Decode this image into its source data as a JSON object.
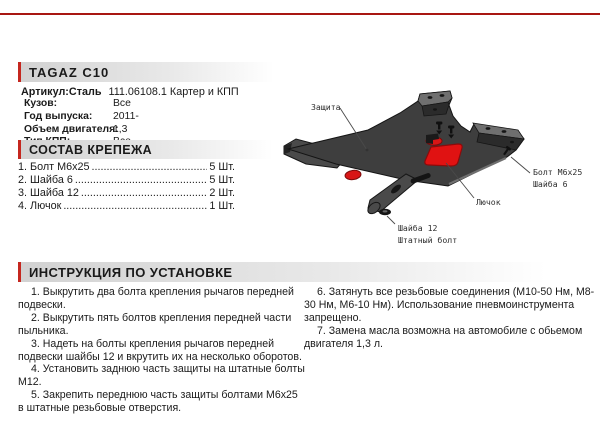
{
  "header": {
    "title": "TAGAZ C10",
    "article_label": "Артикул:Сталь",
    "article_value": "111.06108.1 Картер и КПП"
  },
  "specs": [
    {
      "label": "Кузов:",
      "value": "Все"
    },
    {
      "label": "Год выпуска:",
      "value": "2011-"
    },
    {
      "label": "Объем двигателя:",
      "value": "1,3"
    },
    {
      "label": "Тип КПП:",
      "value": "Все"
    }
  ],
  "fasteners": {
    "title": "СОСТАВ КРЕПЕЖА",
    "items": [
      {
        "name": "1. Болт M6x25",
        "qty": "5 Шт."
      },
      {
        "name": "2. Шайба 6",
        "qty": "5 Шт."
      },
      {
        "name": "3. Шайба 12",
        "qty": "2 Шт."
      },
      {
        "name": "4. Лючок",
        "qty": "1 Шт."
      }
    ]
  },
  "diagram": {
    "labels": {
      "zashita": "Защита",
      "bolt_m6x25": "Болт M6x25",
      "shayba6": "Шайба 6",
      "lyuchok": "Лючок",
      "shayba12": "Шайба 12",
      "shtatny_bolt": "Штатный болт"
    }
  },
  "instructions": {
    "title": "ИНСТРУКЦИЯ ПО УСТАНОВКЕ",
    "left": [
      "1. Выкрутить два болта крепления рычагов передней подвески.",
      "2. Выкрутить пять болтов крепления передней части пыльника.",
      "3. Надеть на болты крепления рычагов передней подвески шайбы 12 и вкрутить их на несколько оборотов.",
      "4. Установить заднюю часть защиты на штатные болты M12.",
      "5. Закрепить переднюю часть защиты болтами M6x25 в штатные резьбовые отверстия."
    ],
    "right": [
      "6. Затянуть все резьбовые соединения (M10-50 Нм, M8-30 Нм, M6-10 Нм). Использование пневмоинструмента запрещено.",
      "7. Замена масла возможна на автомобиле с обьемом двигателя 1,3 л."
    ]
  },
  "colors": {
    "accent_red": "#c5271f",
    "top_rule_red": "#a81712",
    "diagram_red": "#e01212",
    "plate_dark": "#3e3e3e",
    "plate_light": "#6f6f6f"
  }
}
